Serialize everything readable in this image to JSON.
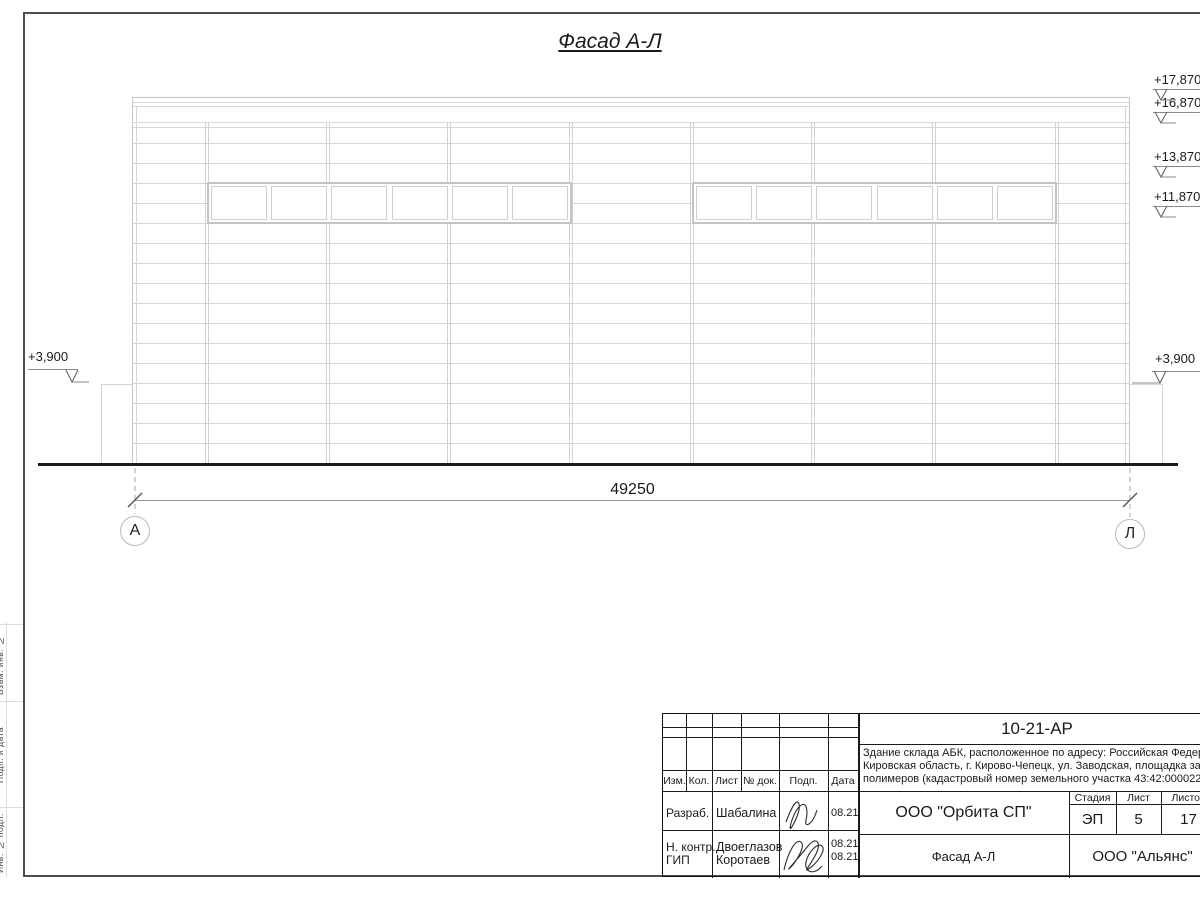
{
  "title": "Фасад А-Л",
  "drawing": {
    "dimension_total": "49250",
    "axis_left": "А",
    "axis_right": "Л",
    "elevation_left": "+3,900",
    "elevation_right_low": "+3,900",
    "elevations_right": [
      {
        "label": "+17,870"
      },
      {
        "label": "+16,870"
      },
      {
        "label": "+13,870"
      },
      {
        "label": "+11,870"
      }
    ]
  },
  "margin": {
    "labels": [
      "Взам. инв. №",
      "Подп. и дата",
      "Инв. № подл."
    ]
  },
  "title_block": {
    "doc_code": "10-21-АР",
    "description_lines": [
      "Здание склада АБК, расположенное по адресу: Российская Федерация,",
      "Кировская область, г. Кирово-Чепецк, ул. Заводская, площадка завода",
      "полимеров (кадастровый номер земельного участка 43:42:000022:3"
    ],
    "header_cols": [
      "Изм.",
      "Кол.",
      "Лист",
      "№ док.",
      "Подп.",
      "Дата"
    ],
    "roles": [
      {
        "role": "Разраб.",
        "name": "Шабалина",
        "date": "08.21"
      },
      {
        "role": "Н. контр.",
        "name": "Двоеглазов",
        "date": "08.21"
      },
      {
        "role": "ГИП",
        "name": "Коротаев",
        "date": "08.21"
      }
    ],
    "company": "ООО \"Орбита СП\"",
    "stage_label": "Стадия",
    "sheet_label": "Лист",
    "sheets_label": "Листов",
    "stage": "ЭП",
    "sheet": "5",
    "sheets": "17",
    "sheet_title": "Фасад А-Л",
    "contractor": "ООО \"Альянс\""
  }
}
